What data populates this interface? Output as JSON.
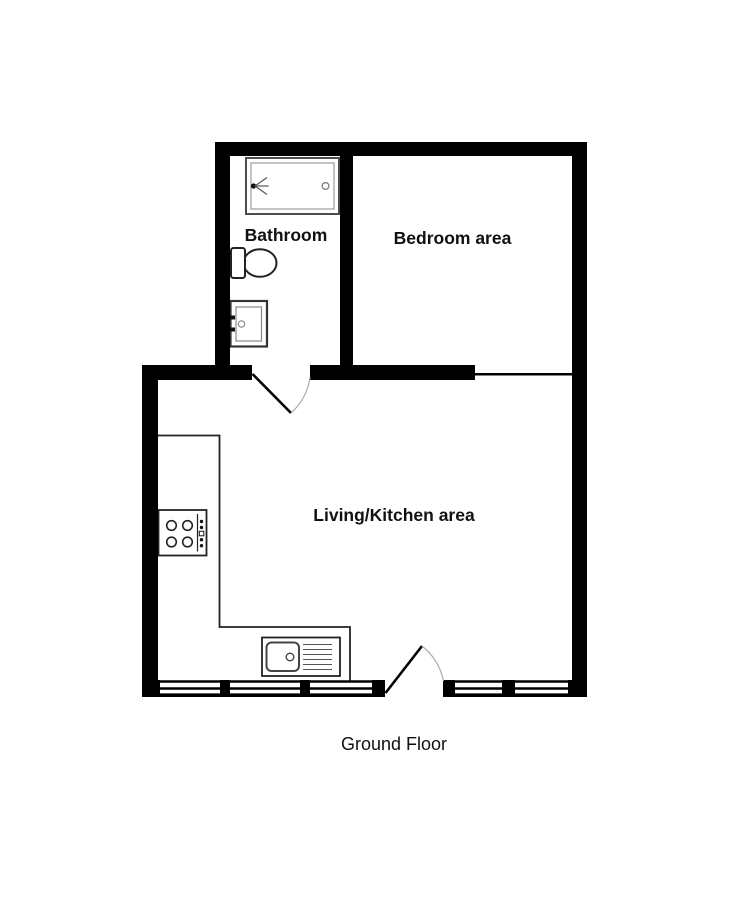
{
  "floor_plan": {
    "title": "Ground Floor",
    "rooms": [
      {
        "id": "bathroom",
        "label": "Bathroom"
      },
      {
        "id": "bedroom",
        "label": "Bedroom area"
      },
      {
        "id": "living-kitchen",
        "label": "Living/Kitchen area"
      }
    ],
    "fixtures": [
      {
        "icon": "bathtub-shower-icon"
      },
      {
        "icon": "toilet-icon"
      },
      {
        "icon": "wash-basin-icon"
      },
      {
        "icon": "hob-icon"
      },
      {
        "icon": "kitchen-sink-drainer-icon"
      },
      {
        "icon": "kitchen-counter-outline"
      }
    ],
    "doors": [
      {
        "id": "bathroom-door"
      },
      {
        "id": "entrance-door"
      }
    ],
    "window_count": 5,
    "colors": {
      "background": "#ffffff",
      "wall": "#000000",
      "fixture_line": "#222222",
      "bath_line": "#4d4d4d",
      "detail_line": "#888888",
      "door_arc": "#aaaaaa",
      "label_text": "#111111"
    }
  }
}
